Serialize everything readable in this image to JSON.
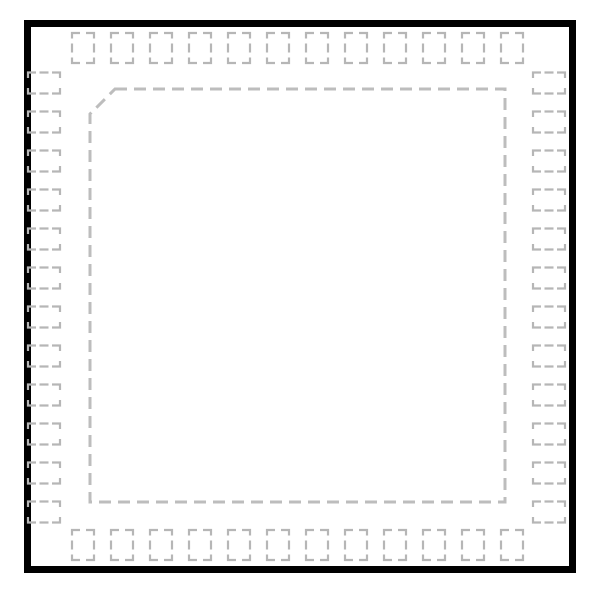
{
  "figure": {
    "type": "ic-package-land-pattern",
    "package_shape": "square",
    "pads_per_side": 12,
    "total_perimeter_pads": 48,
    "pin1_indicator": "chamfered top-left corner of dashed body outline"
  },
  "colors": {
    "background": "#ffffff",
    "outer_border": "#000000",
    "pad_dash": "#b6b6b6",
    "body_outline_dash": "#bdbdbd"
  },
  "canvas": {
    "width": 600,
    "height": 599
  },
  "outer_border": {
    "left": 24,
    "top": 20,
    "right": 576,
    "bottom": 573,
    "stroke_width": 7
  },
  "body_outline": {
    "left": 90,
    "top": 89,
    "right": 505,
    "bottom": 502,
    "chamfer": 25,
    "dash": [
      12,
      7
    ],
    "stroke_width": 3
  },
  "pads": {
    "count_per_side": 12,
    "first_center": 83,
    "pitch": 39,
    "stroke_width": 2.2,
    "corner_arm_h": 8,
    "corner_arm_v": 5.5,
    "mid_dash": 9,
    "top": {
      "edge": 33,
      "across": 22,
      "length": 30
    },
    "bottom": {
      "edge": 530,
      "across": 22,
      "length": 30
    },
    "left": {
      "edge": 28,
      "across": 21,
      "length": 32
    },
    "right": {
      "edge": 533,
      "across": 21,
      "length": 32
    }
  }
}
